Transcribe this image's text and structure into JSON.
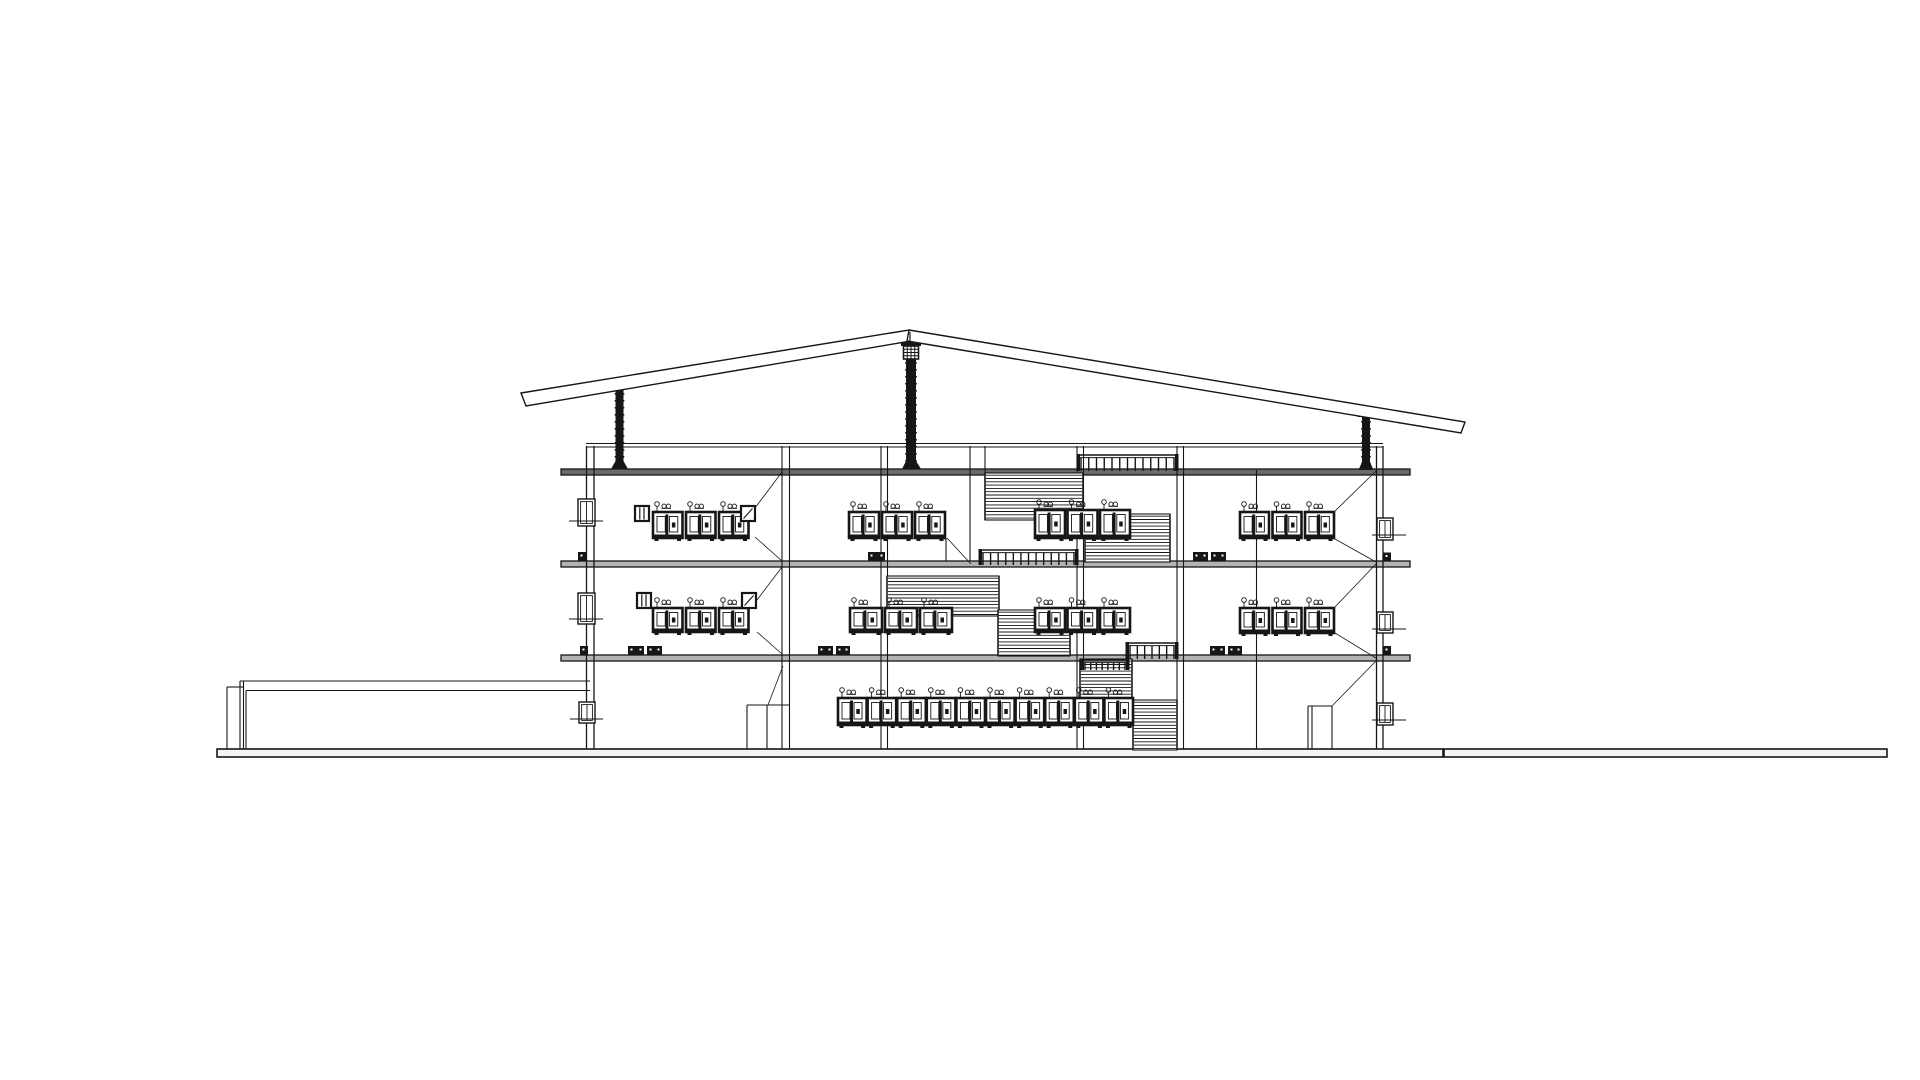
{
  "meta": {
    "drawing_type": "building cross-section line drawing",
    "background": "#ffffff",
    "ink": "#161616",
    "slab_top_fill": "#6b6b6b",
    "slab_fill": "#b3b3b3",
    "ground_fill": "#f4f4f4",
    "canvas": {
      "w": 1920,
      "h": 1080
    }
  },
  "drawing": {
    "ground": {
      "segments": [
        {
          "x": 217,
          "y": 749,
          "w": 1226,
          "h": 8
        },
        {
          "x": 1444,
          "y": 749,
          "w": 443,
          "h": 8
        }
      ]
    },
    "platform": {
      "lines": [
        [
          240,
          681,
          590,
          681
        ],
        [
          246,
          690.5,
          590,
          690.5
        ],
        [
          227,
          687,
          243,
          687
        ],
        [
          227,
          687,
          227,
          749
        ],
        [
          240,
          681,
          240,
          749
        ],
        [
          243.5,
          681,
          243.5,
          749
        ],
        [
          246,
          690.5,
          246,
          749
        ]
      ]
    },
    "roof": {
      "planes": [
        {
          "pts": [
            [
              521,
              393
            ],
            [
              909,
              330
            ],
            [
              911,
              341
            ],
            [
              526,
              406
            ]
          ]
        },
        {
          "pts": [
            [
              909,
              330
            ],
            [
              1465,
              422
            ],
            [
              1461,
              433
            ],
            [
              907,
              341
            ]
          ]
        }
      ],
      "apex_line": [
        910,
        332,
        910,
        343
      ]
    },
    "parapet": {
      "lines": [
        [
          586,
          443.5,
          1383,
          443.5
        ],
        [
          586,
          447,
          1383,
          447
        ]
      ]
    },
    "walls": {
      "lines": [
        [
          586.5,
          446,
          586.5,
          749
        ],
        [
          594,
          446,
          594,
          749
        ],
        [
          1376.5,
          446,
          1376.5,
          749
        ],
        [
          1383,
          446,
          1383,
          749
        ]
      ]
    },
    "columns": {
      "lines": [
        [
          782,
          446,
          782,
          749
        ],
        [
          789.5,
          446,
          789.5,
          749
        ],
        [
          881,
          446,
          881,
          749
        ],
        [
          887.5,
          446,
          887.5,
          749
        ],
        [
          1077,
          446,
          1077,
          749
        ],
        [
          1083.5,
          446,
          1083.5,
          749
        ],
        [
          1177,
          446,
          1177,
          749
        ],
        [
          1183.5,
          446,
          1183.5,
          749
        ],
        [
          1256.5,
          470,
          1256.5,
          749
        ],
        [
          970,
          446,
          970,
          561
        ],
        [
          985,
          446,
          985,
          520
        ],
        [
          946,
          538,
          946,
          561
        ]
      ]
    },
    "slabs": [
      {
        "x": 561,
        "y": 469,
        "w": 849,
        "h": 6,
        "top": true
      },
      {
        "x": 561,
        "y": 561,
        "w": 849,
        "h": 6,
        "top": false
      },
      {
        "x": 561,
        "y": 655,
        "w": 849,
        "h": 6,
        "top": false
      }
    ],
    "pipes": [
      {
        "x": 615.5,
        "w": 8,
        "y1": 389,
        "y2": 469,
        "plate": {
          "x": 610,
          "y": 384,
          "w": 19,
          "h": 5
        },
        "base": {
          "x": 611,
          "w": 17
        }
      },
      {
        "x": 906,
        "w": 10,
        "y1": 358,
        "y2": 469,
        "plate": {
          "x": 901,
          "y": 341,
          "w": 20,
          "h": 5
        },
        "grid": {
          "x": 903.5,
          "y": 346,
          "w": 15,
          "h": 13
        },
        "base": {
          "x": 902,
          "w": 19
        }
      },
      {
        "x": 1362,
        "w": 8,
        "y1": 417,
        "y2": 470,
        "plate": {
          "x": 1357.5,
          "y": 412,
          "w": 17,
          "h": 5
        },
        "base": {
          "x": 1358.5,
          "w": 15
        }
      }
    ],
    "stairs": [
      {
        "x": 985,
        "y": 473,
        "w": 98,
        "h": 47
      },
      {
        "x": 1085,
        "y": 514,
        "w": 85,
        "h": 48
      },
      {
        "x": 887,
        "y": 576,
        "w": 112,
        "h": 40
      },
      {
        "x": 998,
        "y": 610,
        "w": 72,
        "h": 46
      },
      {
        "x": 1080,
        "y": 659,
        "w": 52,
        "h": 44
      },
      {
        "x": 1133,
        "y": 700,
        "w": 44,
        "h": 50
      }
    ],
    "railings": [
      {
        "x": 1078,
        "y": 455,
        "w": 99,
        "h": 16,
        "n": 13
      },
      {
        "x": 980,
        "y": 550,
        "w": 97,
        "h": 15,
        "n": 13
      },
      {
        "x": 1127,
        "y": 643,
        "w": 50,
        "h": 16,
        "n": 7
      },
      {
        "x": 1082,
        "y": 660,
        "w": 46,
        "h": 10,
        "n": 8
      }
    ],
    "clusters": [
      {
        "x": 653,
        "y": 512,
        "h": 26,
        "units": 3,
        "uw": 29.5,
        "gap": 3.5,
        "box_left": {
          "x": 635,
          "y": 506
        },
        "box_right": {
          "x": 741,
          "y": 506
        }
      },
      {
        "x": 849,
        "y": 512,
        "h": 26,
        "units": 3,
        "uw": 30,
        "gap": 3
      },
      {
        "x": 1035,
        "y": 510,
        "h": 28,
        "units": 3,
        "uw": 30,
        "gap": 2.5
      },
      {
        "x": 1240,
        "y": 512,
        "h": 26,
        "units": 3,
        "uw": 29,
        "gap": 3.5
      },
      {
        "x": 653,
        "y": 608,
        "h": 24,
        "units": 3,
        "uw": 29.5,
        "gap": 3.5,
        "box_left": {
          "x": 637,
          "y": 593
        },
        "box_right": {
          "x": 742,
          "y": 593
        }
      },
      {
        "x": 850,
        "y": 608,
        "h": 24,
        "units": 3,
        "uw": 32,
        "gap": 3
      },
      {
        "x": 1035,
        "y": 608,
        "h": 24,
        "units": 3,
        "uw": 30,
        "gap": 2.5
      },
      {
        "x": 1240,
        "y": 608,
        "h": 25,
        "units": 3,
        "uw": 29,
        "gap": 3.5
      },
      {
        "x": 838,
        "y": 698,
        "h": 27,
        "units": 10,
        "uw": 28.6,
        "gap": 1
      }
    ],
    "wall_windows": [
      {
        "x": 578,
        "y": 499,
        "w": 17,
        "h": 27,
        "tick_y": 521,
        "tx1": 569,
        "tx2": 603
      },
      {
        "x": 578,
        "y": 593,
        "w": 17,
        "h": 31,
        "tick_y": 619,
        "tx1": 569,
        "tx2": 603
      },
      {
        "x": 579,
        "y": 702,
        "w": 16,
        "h": 21,
        "tick_y": 719,
        "tx1": 570,
        "tx2": 603
      },
      {
        "x": 1377,
        "y": 518,
        "w": 16,
        "h": 22,
        "tick_y": 535,
        "tx1": 1372,
        "tx2": 1406
      },
      {
        "x": 1377,
        "y": 612,
        "w": 16,
        "h": 21,
        "tick_y": 629,
        "tx1": 1372,
        "tx2": 1406
      },
      {
        "x": 1377,
        "y": 703,
        "w": 16,
        "h": 22,
        "tick_y": 720,
        "tx1": 1372,
        "tx2": 1406
      }
    ],
    "doors": {
      "lines": [
        [
          747,
          705,
          790,
          705
        ],
        [
          747,
          705,
          747,
          749
        ],
        [
          767,
          705,
          767,
          749
        ],
        [
          1308,
          706,
          1332,
          706
        ],
        [
          1308,
          706,
          1308,
          749
        ],
        [
          1312,
          706,
          1312,
          749
        ],
        [
          1332,
          706,
          1332,
          749
        ]
      ]
    },
    "beam_blocks": [
      {
        "x": 868,
        "y": 552,
        "w": 17,
        "h": 9
      },
      {
        "x": 1193,
        "y": 552,
        "w": 15,
        "h": 9
      },
      {
        "x": 1211,
        "y": 552,
        "w": 15,
        "h": 9
      },
      {
        "x": 578,
        "y": 552,
        "w": 8,
        "h": 9
      },
      {
        "x": 1383,
        "y": 552.5,
        "w": 8,
        "h": 9
      },
      {
        "x": 628,
        "y": 646,
        "w": 16,
        "h": 9
      },
      {
        "x": 647,
        "y": 646,
        "w": 15,
        "h": 9
      },
      {
        "x": 818,
        "y": 646,
        "w": 15,
        "h": 9
      },
      {
        "x": 836,
        "y": 646,
        "w": 14,
        "h": 9
      },
      {
        "x": 1210,
        "y": 646,
        "w": 15,
        "h": 9
      },
      {
        "x": 1228,
        "y": 646,
        "w": 14,
        "h": 9
      },
      {
        "x": 580,
        "y": 646,
        "w": 8,
        "h": 9
      },
      {
        "x": 1383,
        "y": 646,
        "w": 8,
        "h": 9
      }
    ],
    "leaders": [
      [
        755,
        508,
        782,
        472
      ],
      [
        755,
        537,
        782,
        561
      ],
      [
        1334,
        512,
        1376,
        471
      ],
      [
        1335,
        539,
        1376,
        562
      ],
      [
        757,
        600,
        782,
        567
      ],
      [
        757,
        632,
        782,
        654
      ],
      [
        1334,
        608,
        1376,
        564
      ],
      [
        1335,
        633,
        1376,
        658
      ],
      [
        947,
        538,
        971,
        564
      ],
      [
        768,
        705,
        783,
        666
      ],
      [
        1332,
        706,
        1376,
        661
      ]
    ]
  }
}
